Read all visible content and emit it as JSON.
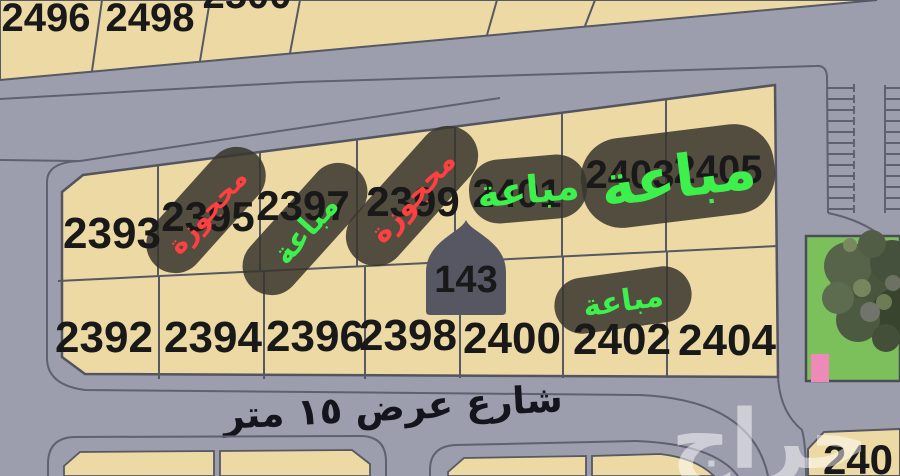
{
  "street": {
    "label": "شارع عرض ١٥ متر"
  },
  "marker": {
    "number": "143"
  },
  "watermark": {
    "text": "حراج"
  },
  "plots": {
    "top_strip": [
      "2496",
      "2498",
      "2500"
    ],
    "main_top": [
      "2393",
      "2395",
      "2397",
      "2399",
      "2401",
      "2403",
      "2405"
    ],
    "main_bottom": [
      "2392",
      "2394",
      "2396",
      "2398",
      "2400",
      "2402",
      "2404"
    ],
    "bottom_right": "240"
  },
  "labels": [
    {
      "plot": "2395",
      "text": "محجوزة",
      "status": "reserved",
      "color": "#ff4040"
    },
    {
      "plot": "2397",
      "text": "مباعة",
      "status": "sold",
      "color": "#3df04b"
    },
    {
      "plot": "2399",
      "text": "محجوزة",
      "status": "reserved",
      "color": "#ff4040"
    },
    {
      "plot": "2401",
      "text": "مباعة",
      "status": "sold",
      "color": "#3df04b"
    },
    {
      "plot": "2403-2405",
      "text": "مباعة",
      "status": "sold",
      "color": "#3df04b"
    },
    {
      "plot": "2402",
      "text": "مباعة",
      "status": "sold",
      "color": "#3df04b"
    }
  ],
  "colors": {
    "plot_fill": "#ecd9a3",
    "street": "#9d9ead",
    "pill": "rgba(56,54,45,0.86)",
    "sold_green": "#3df04b",
    "reserved_red": "#ff4040",
    "marker_gold": "#c2973a",
    "marker_bg": "#565763",
    "park_green": "#7cc05c",
    "building_pink": "#ee8ab8",
    "watermark_white": "rgba(255,255,255,0.5)"
  }
}
